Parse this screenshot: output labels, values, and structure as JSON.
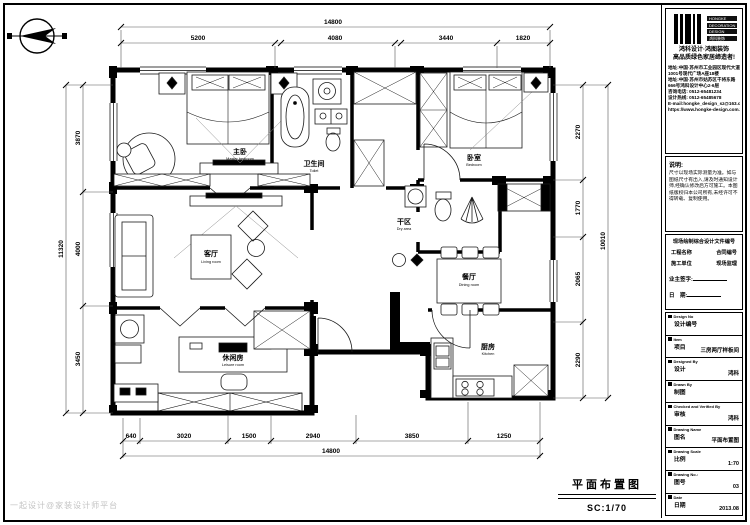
{
  "title": {
    "name": "平面布置图",
    "scale": "SC:1/70"
  },
  "watermark": "一起设计@家装设计师平台",
  "dimensions": {
    "top": {
      "overall": "14800",
      "segments": [
        "5200",
        "4080",
        "3440",
        "1820"
      ]
    },
    "bottom": {
      "overall": "14800",
      "segments": [
        "640",
        "3020",
        "1500",
        "2940",
        "3850",
        "1250"
      ]
    },
    "left": {
      "overall": "11320",
      "segments": [
        "3870",
        "4000",
        "3450"
      ]
    },
    "right": {
      "overall": "10010",
      "segments": [
        "2270",
        "1770",
        "2065",
        "2290"
      ]
    }
  },
  "rooms": {
    "master": {
      "zh": "主卧",
      "en": "Master bedroom"
    },
    "bath1": {
      "zh": "卫生间",
      "en": "Toilet"
    },
    "bedroom2": {
      "zh": "卧室",
      "en": "Bedroom"
    },
    "dry": {
      "zh": "干区",
      "en": "Dry area"
    },
    "living": {
      "zh": "客厅",
      "en": "Living room"
    },
    "dining": {
      "zh": "餐厅",
      "en": "Dining room"
    },
    "kitchen": {
      "zh": "厨房",
      "en": "Kitchen"
    },
    "study": {
      "zh": "休闲房",
      "en": "Leisure room"
    }
  },
  "panel": {
    "logo_lines": [
      "HONGKE",
      "DECORATION",
      "DESIGN",
      "鸿科装饰"
    ],
    "slogan1": "鸿科设计·鸿图装饰",
    "slogan2": "高品质绿色家居缔造者!",
    "contact_lines": [
      "地址:中国·苏州市工业园区现代大道",
      "1001号现代广场A座18楼",
      "地址:中国·苏州市姑苏区干将东路",
      "666号鸿科设计中心2-6层",
      "咨询电话: 0512-65481234",
      "设计热线: 0512-65485678",
      "E-mail:hongke_design_sz@163.com",
      "https://www.hongke-design.com.tw"
    ],
    "note_title": "说明:",
    "note_body": "尺寸以现场实际测量为准。如与图纸尺寸有出入,请及时通知设计师,经确认修改后方可施工。本图纸版权归本公司所有,未经许可不得转载、复制使用。",
    "sign_title": "现场绘制综合设计文件编号",
    "sign_row1a": "工程名称",
    "sign_row1b": "合同编号",
    "sign_row2a": "施工单位",
    "sign_row2b": "现场监理",
    "owner_sign": "业主签字:",
    "date_sign": "日　期:",
    "rows": [
      {
        "en": "Design No",
        "zh": "设计编号",
        "value": ""
      },
      {
        "en": "Item",
        "zh": "项目",
        "value": "三房两厅样板间"
      },
      {
        "en": "Designed By",
        "zh": "设计",
        "value": "鸿科"
      },
      {
        "en": "Drawn By",
        "zh": "制图",
        "value": ""
      },
      {
        "en": "Checked and Verified By",
        "zh": "审核",
        "value": "鸿科"
      },
      {
        "en": "Drawing Name",
        "zh": "图名",
        "value": "平面布置图"
      },
      {
        "en": "Drawing Scale",
        "zh": "比例",
        "value": "1:70"
      },
      {
        "en": "Drawing No.:",
        "zh": "图号",
        "value": "03"
      },
      {
        "en": "Date",
        "zh": "日期",
        "value": "2013.08"
      }
    ]
  }
}
